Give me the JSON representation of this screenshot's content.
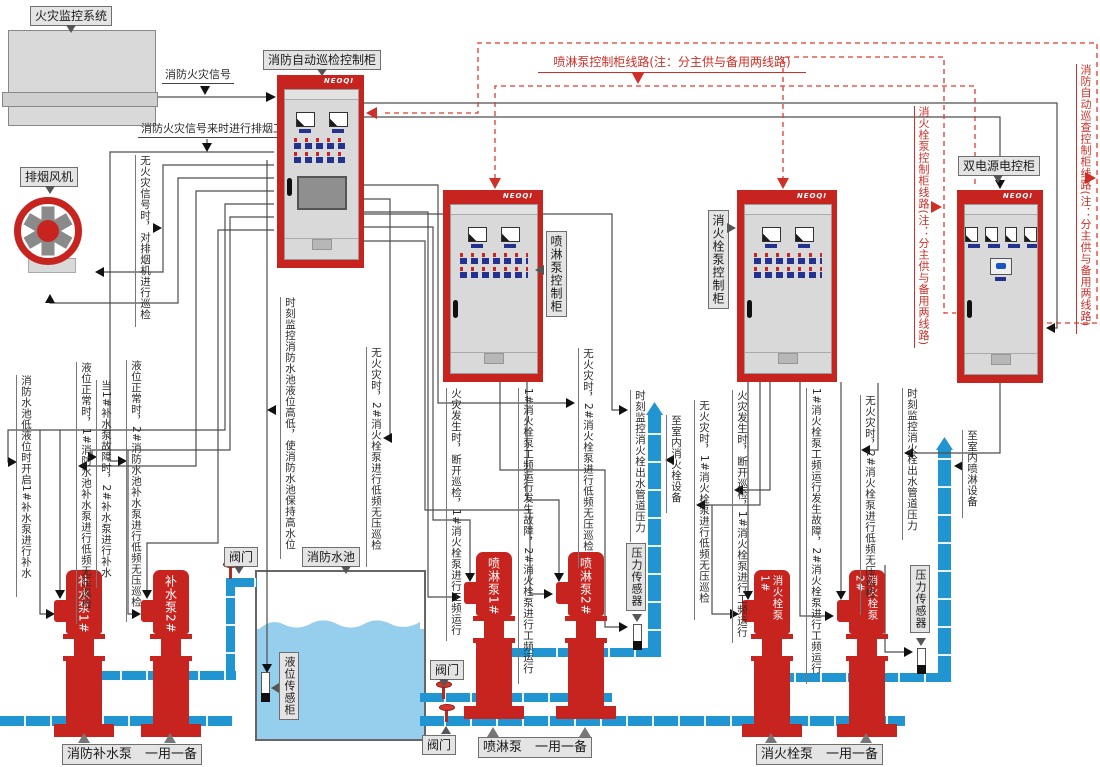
{
  "colors": {
    "cabinet_red": "#c8241f",
    "pipe_blue": "#2095d2",
    "water_blue": "#96cfee",
    "wire_gray": "#4d4d4d",
    "dashed_red": "#e03a2f",
    "panel_gray": "#d9d9d9",
    "label_bg": "#e4e4e4"
  },
  "labels": {
    "fire_system": "火灾监控系统",
    "main_cabinet": "消防自动巡检控制柜",
    "fan": "排烟风机",
    "spray_cabinet": "喷淋泵控制柜",
    "hydrant_cabinet": "消火栓泵控制柜",
    "dual_power_cabinet": "双电源电控柜",
    "pool": "消防水池",
    "valve": "阀门",
    "level_sensor": "液位传感柜",
    "pressure_sensor": "压力传感器",
    "brand": "NEOQI"
  },
  "pumps": {
    "makeup1": "补水泵1#",
    "makeup2": "补水泵2#",
    "spray1": "喷淋泵1#",
    "spray2": "喷淋泵2#",
    "hydrant1": "消火栓泵1#",
    "hydrant2": "消火栓泵2#"
  },
  "footers": {
    "makeup": "消防补水泵　一用一备",
    "spray": "喷淋泵　一用一备",
    "hydrant": "消火栓泵　一用一备"
  },
  "signals": {
    "fire_signal": "消防火灾信号",
    "smoke_work": "消防火灾信号来时进行排烟工作"
  },
  "notes": {
    "fan_note": "无火灾信号时，对排烟机进行巡检",
    "mk_a": "消防水池低液位时开启1#补水泵进行补水",
    "mk_b": "液位正常时，1#消防水池补水泵进行低频无压巡检",
    "mk_c": "当1#补水泵故障时，2#补水泵进行补水",
    "mk_d": "液位正常时，2#消防水池补水泵进行低频无压巡检",
    "pool_level": "时刻监控消防水池液位高低，使消防水池保持高水位",
    "sp_idle2_left": "无火灾时，2#消火栓泵进行低频无压巡检",
    "sp_fire": "火灾发生时，断开巡检，1#消火栓泵进行工频运行",
    "sp_fault": "1#消火栓泵工频运行发生故障，2#消火栓泵进行工频运行",
    "sp_idle2": "无火灾时，2#消火栓泵进行低频无压巡检",
    "sp_pressure": "时刻监控消火栓出水管道压力",
    "sp_to": "至室内消火栓设备",
    "hy_idle1": "无火灾时，1#消火栓泵进行低频无压巡检",
    "hy_fire": "火灾发生时，断开巡检，1#消火栓泵进行工频运行",
    "hy_fault": "1#消火栓泵工频运行发生故障，2#消火栓泵进行工频运行",
    "hy_idle2": "无火灾时，2#消火栓泵进行低频无压巡检",
    "hy_pressure": "时刻监控消火栓出水管道压力",
    "hy_to": "至室内喷淋设备"
  },
  "red_notes": {
    "spray_line": "喷淋泵控制柜线路(注：分主供与备用两线路)",
    "hydrant_line": "消火栓泵控制柜线路(注：分主供与备用两线路)",
    "auto_line": "消防自动巡查控制柜线路(注：分主供与备用两线路)"
  }
}
